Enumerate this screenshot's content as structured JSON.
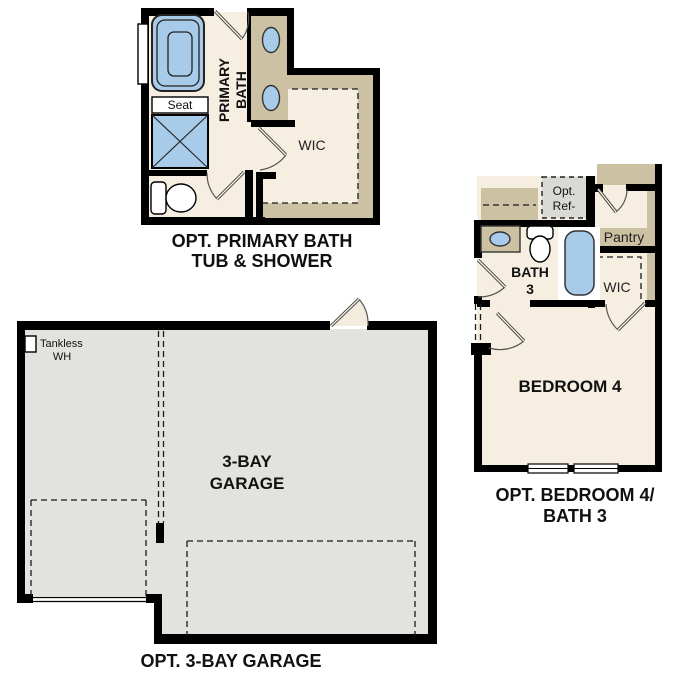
{
  "colors": {
    "wall": "#000000",
    "bath_floor": "#f6efe1",
    "cabinet_tan": "#cdc1a4",
    "fixture_blue": "#a9cbea",
    "garage_floor": "#e2e2df",
    "optional_ref_gray": "#d9d9d6",
    "text": "#111111"
  },
  "sections": {
    "primary_bath": {
      "title_line1": "OPT. PRIMARY BATH",
      "title_line2": "TUB & SHOWER",
      "room_line1": "PRIMARY",
      "room_line2": "BATH",
      "wic": "WIC",
      "seat": "Seat"
    },
    "bedroom4_bath3": {
      "title_line1": "OPT. BEDROOM 4/",
      "title_line2": "BATH 3",
      "bedroom": "BEDROOM 4",
      "bath_line1": "BATH",
      "bath_line2": "3",
      "wic": "WIC",
      "pantry": "Pantry",
      "ref_line1": "Opt.",
      "ref_line2": "Ref-"
    },
    "garage": {
      "title": "OPT. 3-BAY GARAGE",
      "room_line1": "3-BAY",
      "room_line2": "GARAGE",
      "wh_line1": "Tankless",
      "wh_line2": "WH"
    }
  }
}
